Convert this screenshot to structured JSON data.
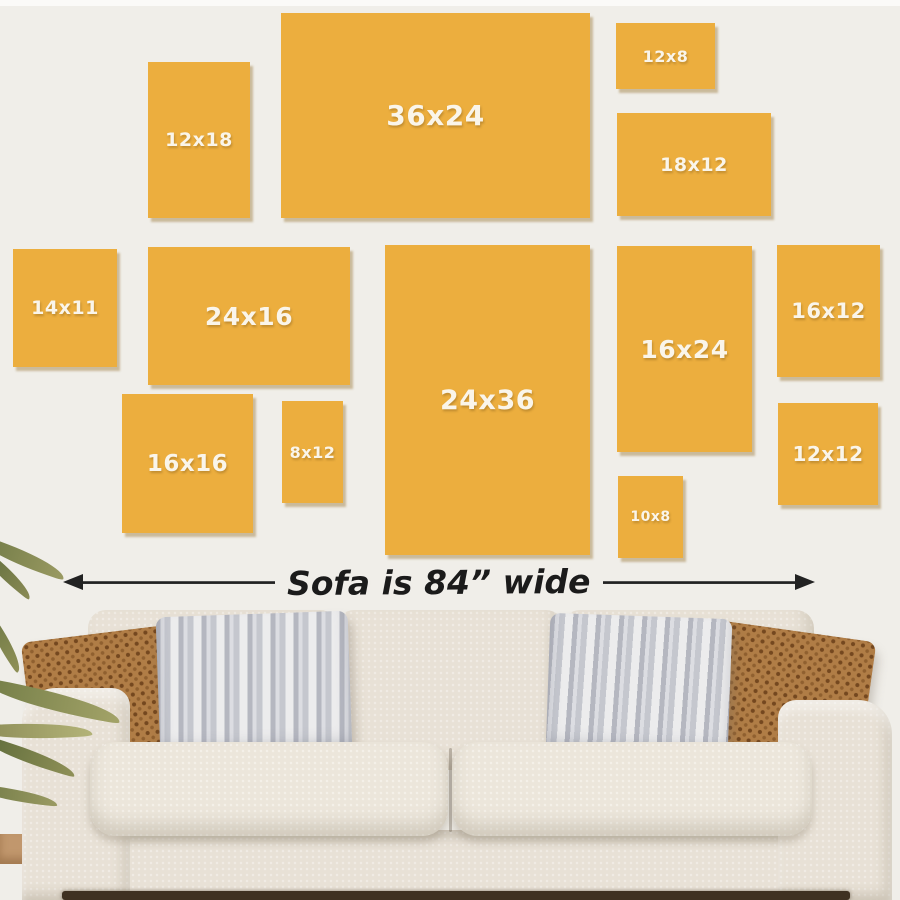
{
  "title": "Canvas print size guide above a sofa",
  "colors": {
    "wall": "#f0eee9",
    "frame_fill": "#ecae3e",
    "frame_label": "#faf5ea",
    "arrow": "#222222",
    "sofa_fabric": "#e8e1d6",
    "sofa_cushion": "#ece6db",
    "pillow_brown": "#b07d46",
    "pillow_gray": "#cccdd3",
    "leaf_green": "#82854f",
    "floor": "#3f3122"
  },
  "frames": [
    {
      "label": "12x18",
      "x": 148,
      "y": 62,
      "w": 102,
      "h": 156,
      "font": 19
    },
    {
      "label": "36x24",
      "x": 281,
      "y": 13,
      "w": 309,
      "h": 205,
      "font": 28
    },
    {
      "label": "12x8",
      "x": 616,
      "y": 23,
      "w": 99,
      "h": 66,
      "font": 16
    },
    {
      "label": "18x12",
      "x": 617,
      "y": 113,
      "w": 154,
      "h": 103,
      "font": 19
    },
    {
      "label": "14x11",
      "x": 13,
      "y": 249,
      "w": 104,
      "h": 118,
      "font": 19
    },
    {
      "label": "24x16",
      "x": 148,
      "y": 247,
      "w": 202,
      "h": 138,
      "font": 25
    },
    {
      "label": "24x36",
      "x": 385,
      "y": 245,
      "w": 205,
      "h": 310,
      "font": 27
    },
    {
      "label": "16x24",
      "x": 617,
      "y": 246,
      "w": 135,
      "h": 206,
      "font": 25
    },
    {
      "label": "16x12",
      "x": 777,
      "y": 245,
      "w": 103,
      "h": 132,
      "font": 21
    },
    {
      "label": "16x16",
      "x": 122,
      "y": 394,
      "w": 131,
      "h": 139,
      "font": 23
    },
    {
      "label": "8x12",
      "x": 282,
      "y": 401,
      "w": 61,
      "h": 102,
      "font": 16
    },
    {
      "label": "10x8",
      "x": 618,
      "y": 476,
      "w": 65,
      "h": 82,
      "font": 14
    },
    {
      "label": "12x12",
      "x": 778,
      "y": 403,
      "w": 100,
      "h": 102,
      "font": 20
    }
  ],
  "sofa": {
    "caption": "Sofa is 84” wide"
  }
}
